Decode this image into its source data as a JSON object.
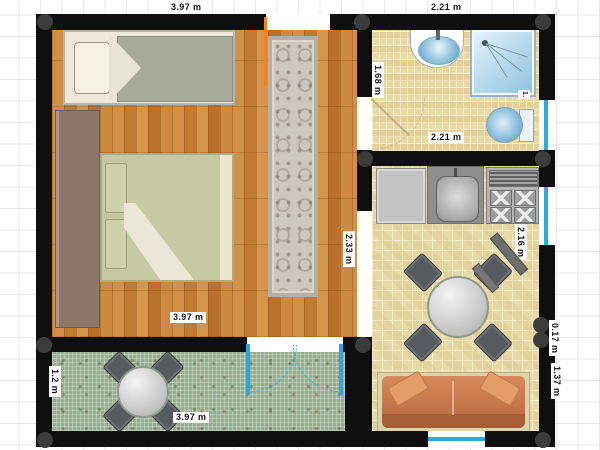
{
  "app": {
    "view": "floor-plan-canvas"
  },
  "colors": {
    "wall": "#0f0f0f",
    "node": "#3c3c3c",
    "window_accent": "#29abe2",
    "entry_door_accent": "#f5821f",
    "wood_floor": "#c9853f",
    "tile_floor": "#e9d9a2",
    "mosaic_floor": "#96ad8f",
    "sofa": "#c87a4e"
  },
  "rooms": [
    {
      "id": "bedroom",
      "floor": "wood-parquet"
    },
    {
      "id": "bathroom",
      "floor": "yellow-tile"
    },
    {
      "id": "kitchen-living",
      "floor": "yellow-tile"
    },
    {
      "id": "patio",
      "floor": "green-mosaic"
    },
    {
      "id": "hallway-opening",
      "floor": "white"
    }
  ],
  "dimension_labels": [
    {
      "id": "bedroom-width-top",
      "text": "3.97 m",
      "orientation": "horizontal"
    },
    {
      "id": "bathroom-width-top",
      "text": "2.21 m",
      "orientation": "horizontal"
    },
    {
      "id": "bathroom-height",
      "text": "1.68 m",
      "orientation": "vertical"
    },
    {
      "id": "bathroom-width-inner",
      "text": "2.21 m",
      "orientation": "horizontal"
    },
    {
      "id": "toilet-bay-truncated",
      "text": "1.",
      "orientation": "vertical"
    },
    {
      "id": "hall-opening-height",
      "text": "2.33 m",
      "orientation": "vertical"
    },
    {
      "id": "bedroom-width-bottom",
      "text": "3.97 m",
      "orientation": "horizontal"
    },
    {
      "id": "living-wall-segment",
      "text": "2.16 m",
      "orientation": "vertical"
    },
    {
      "id": "patio-depth",
      "text": "1.2 m",
      "orientation": "vertical"
    },
    {
      "id": "patio-width",
      "text": "3.97 m",
      "orientation": "horizontal"
    },
    {
      "id": "right-wall-short",
      "text": "0.17 m",
      "orientation": "vertical"
    },
    {
      "id": "right-wall-lower",
      "text": "1.37 m",
      "orientation": "vertical"
    }
  ],
  "objects": {
    "bedroom": [
      "single-bed",
      "wardrobe",
      "double-bed",
      "ornamental-rug",
      "entry-door"
    ],
    "bathroom": [
      "washbasin",
      "shower-cabin",
      "toilet",
      "bathroom-door"
    ],
    "kitchen_living": [
      "kitchen-counter",
      "kitchen-sink",
      "stove",
      "dining-table",
      "dining-chairs-x4",
      "sofa",
      "wall-shelf"
    ],
    "patio": [
      "patio-table",
      "patio-chairs-x4",
      "french-double-doors"
    ],
    "windows": [
      "bathroom-window-right",
      "kitchen-window-right",
      "living-window-bottom"
    ]
  }
}
